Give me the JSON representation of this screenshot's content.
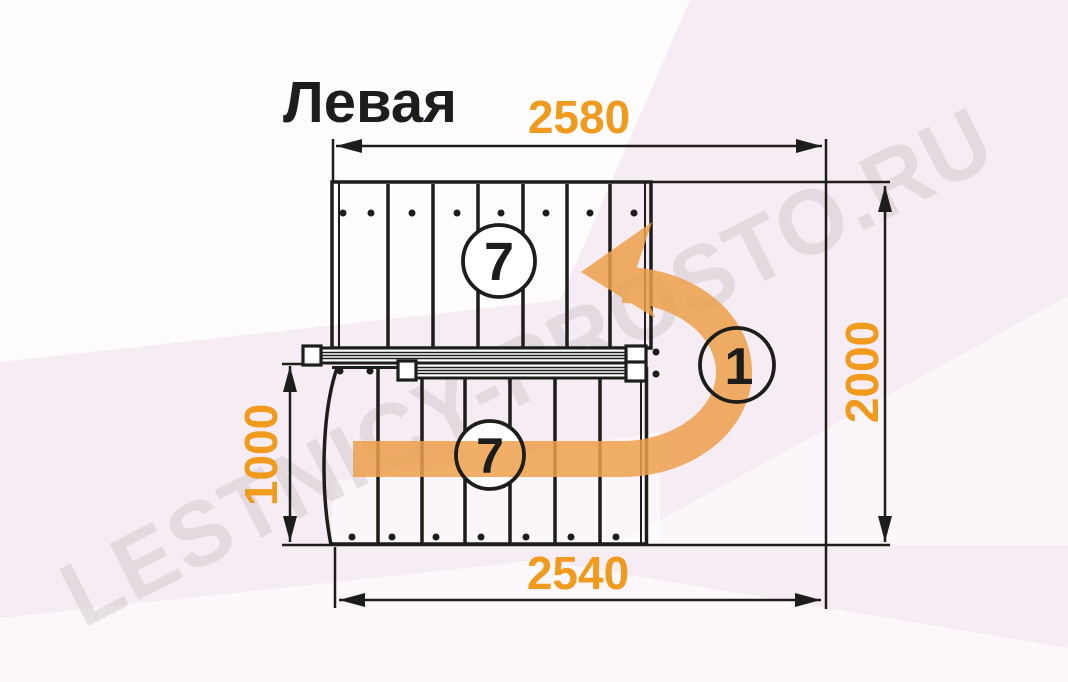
{
  "title": "Левая",
  "watermark": "LESTNICY-PROSTO.RU",
  "dimensions": {
    "top": "2580",
    "bottom": "2540",
    "right": "2000",
    "left": "1000"
  },
  "step_counts": {
    "upper_flight": "7",
    "lower_flight": "7",
    "landing": "1"
  },
  "colors": {
    "dimension_orange": "#f09a1e",
    "arrow_orange": "#eda04b",
    "linework_black": "#1d1d1b",
    "background_pink": "#f6ecf3",
    "watermark_gray": "#d4ccd2"
  }
}
